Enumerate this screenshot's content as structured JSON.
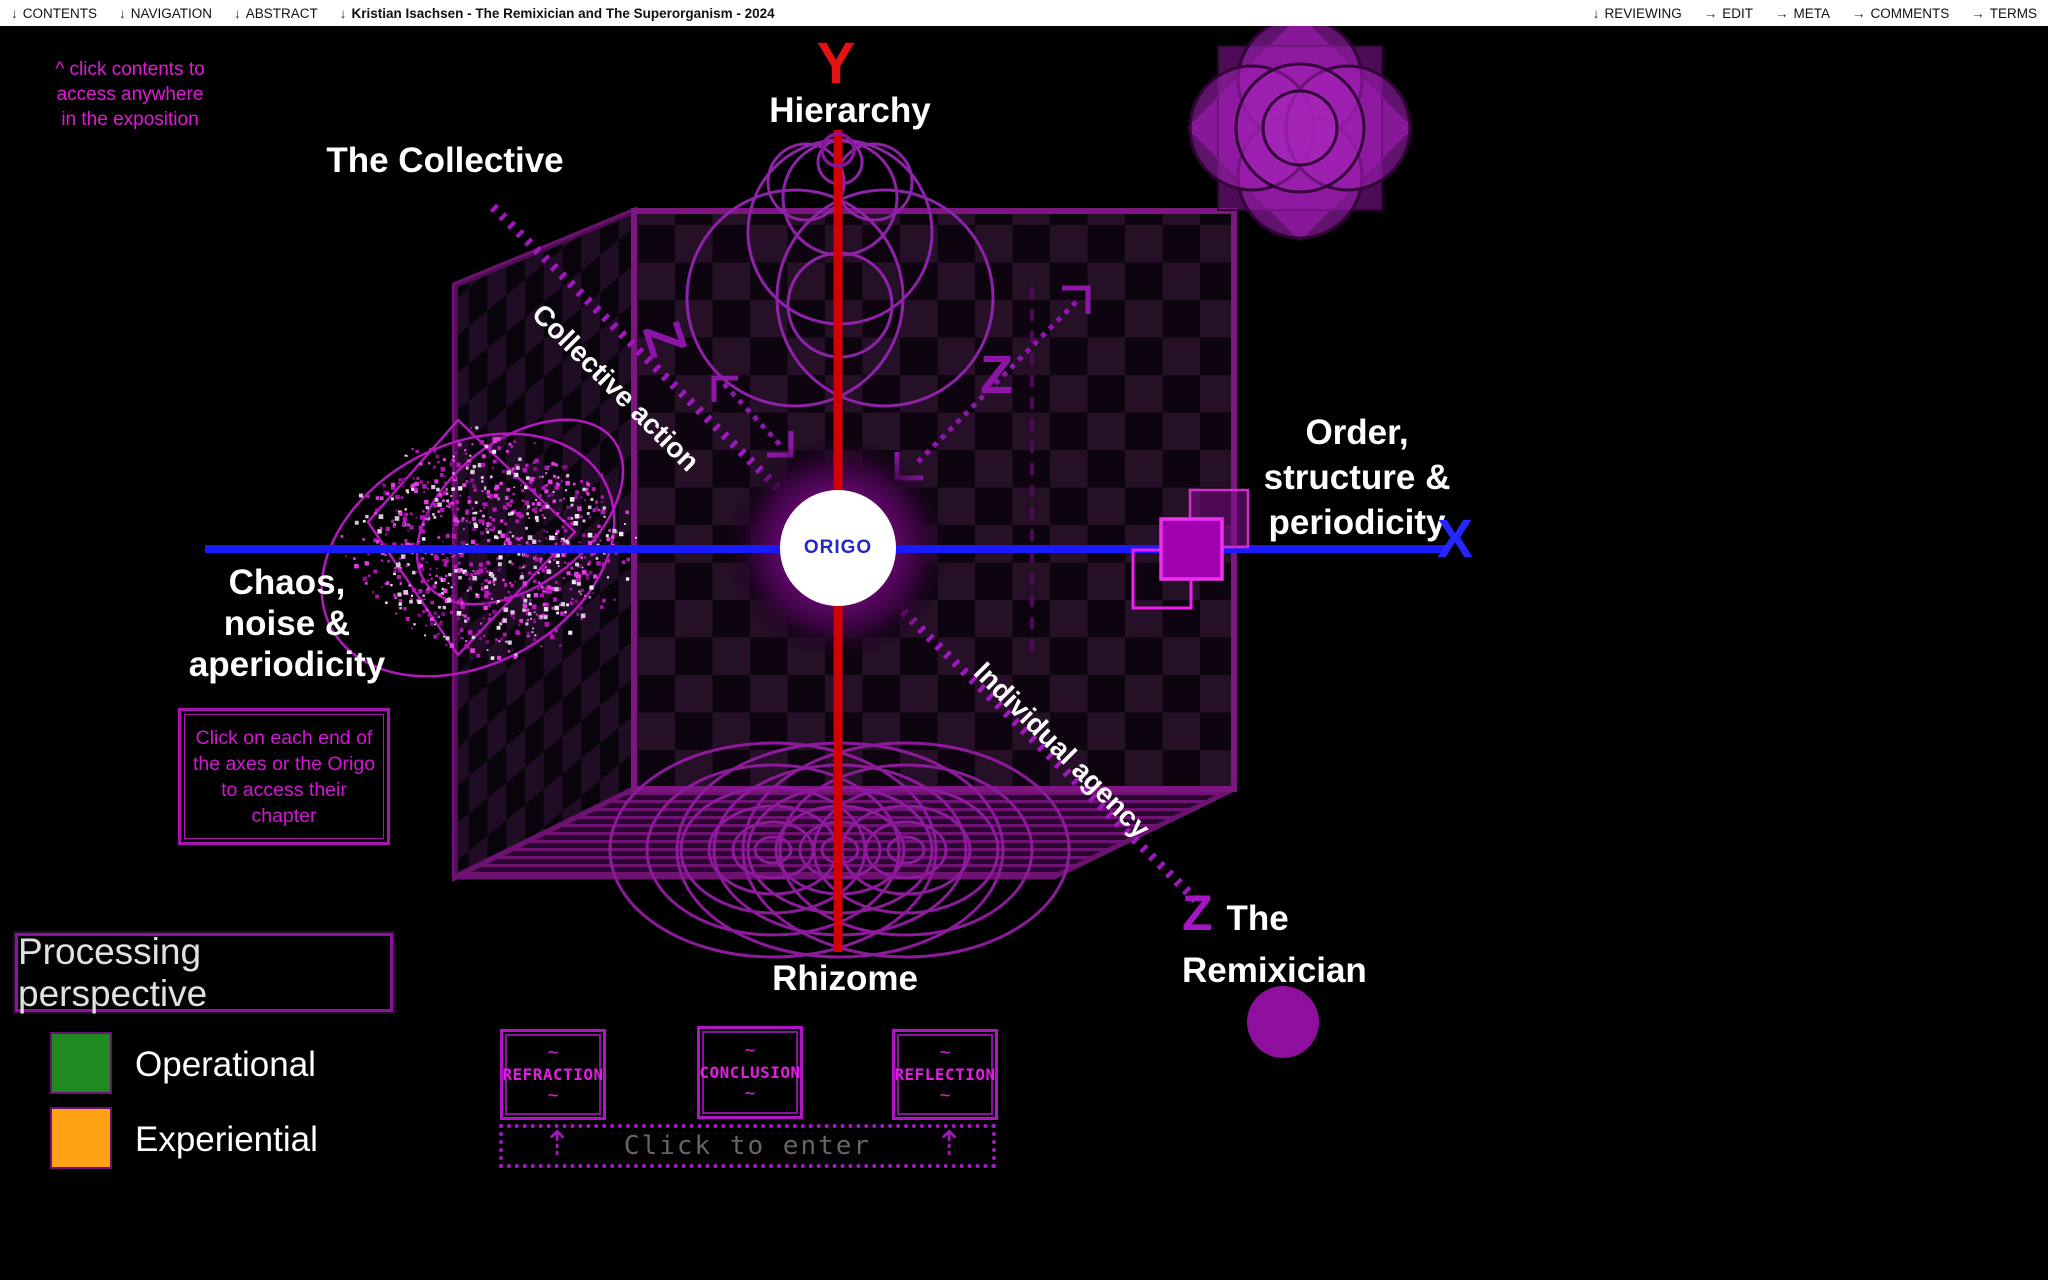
{
  "title_bar": {
    "left": [
      {
        "icon": "↓",
        "label": "CONTENTS"
      },
      {
        "icon": "↓",
        "label": "NAVIGATION"
      },
      {
        "icon": "↓",
        "label": "ABSTRACT"
      },
      {
        "icon": "↓",
        "label": "Kristian Isachsen - The Remixician and The Superorganism - 2024"
      }
    ],
    "right": [
      {
        "icon": "↓",
        "label": "REVIEWING"
      },
      {
        "icon": "→",
        "label": "EDIT"
      },
      {
        "icon": "→",
        "label": "META"
      },
      {
        "icon": "→",
        "label": "COMMENTS"
      },
      {
        "icon": "→",
        "label": "TERMS"
      }
    ]
  },
  "note": {
    "line1": "^ click contents to",
    "line2": "access anywhere",
    "line3": "in the exposition"
  },
  "diagram": {
    "origo": "ORIGO",
    "y_letter": "Y",
    "y_top": "Hierarchy",
    "y_bottom": "Rhizome",
    "x_letter": "X",
    "x_right": {
      "l1": "Order,",
      "l2": "structure &",
      "l3": "periodicity"
    },
    "x_left": {
      "l1": "Chaos,",
      "l2": "noise &",
      "l3": "aperiodicity"
    },
    "z_letter": "Z",
    "z_top": "The Collective",
    "z_bottom": {
      "l1": "The",
      "l2": "Remixician"
    },
    "z_upper_axis": "Collective action",
    "z_lower_axis": "Individual agency"
  },
  "instruction": {
    "l1": "Click on each end of",
    "l2": "the axes or the Origo",
    "l3": "to access their",
    "l4": "chapter"
  },
  "legend": {
    "title": "Processing perspective",
    "items": [
      {
        "label": "Operational",
        "color": "#1e8a1f"
      },
      {
        "label": "Experiential",
        "color": "#ffa216"
      }
    ]
  },
  "chapters": {
    "decor": "~",
    "items": [
      {
        "label": "REFRACTION"
      },
      {
        "label": "CONCLUSION"
      },
      {
        "label": "REFLECTION"
      }
    ]
  },
  "enter": {
    "label": "Click to enter",
    "arrow": "⇡"
  },
  "colors": {
    "y_axis": "#d40000",
    "x_axis": "#1a1aff",
    "z_axis": "#a116c0",
    "magenta": "#e020d0"
  }
}
